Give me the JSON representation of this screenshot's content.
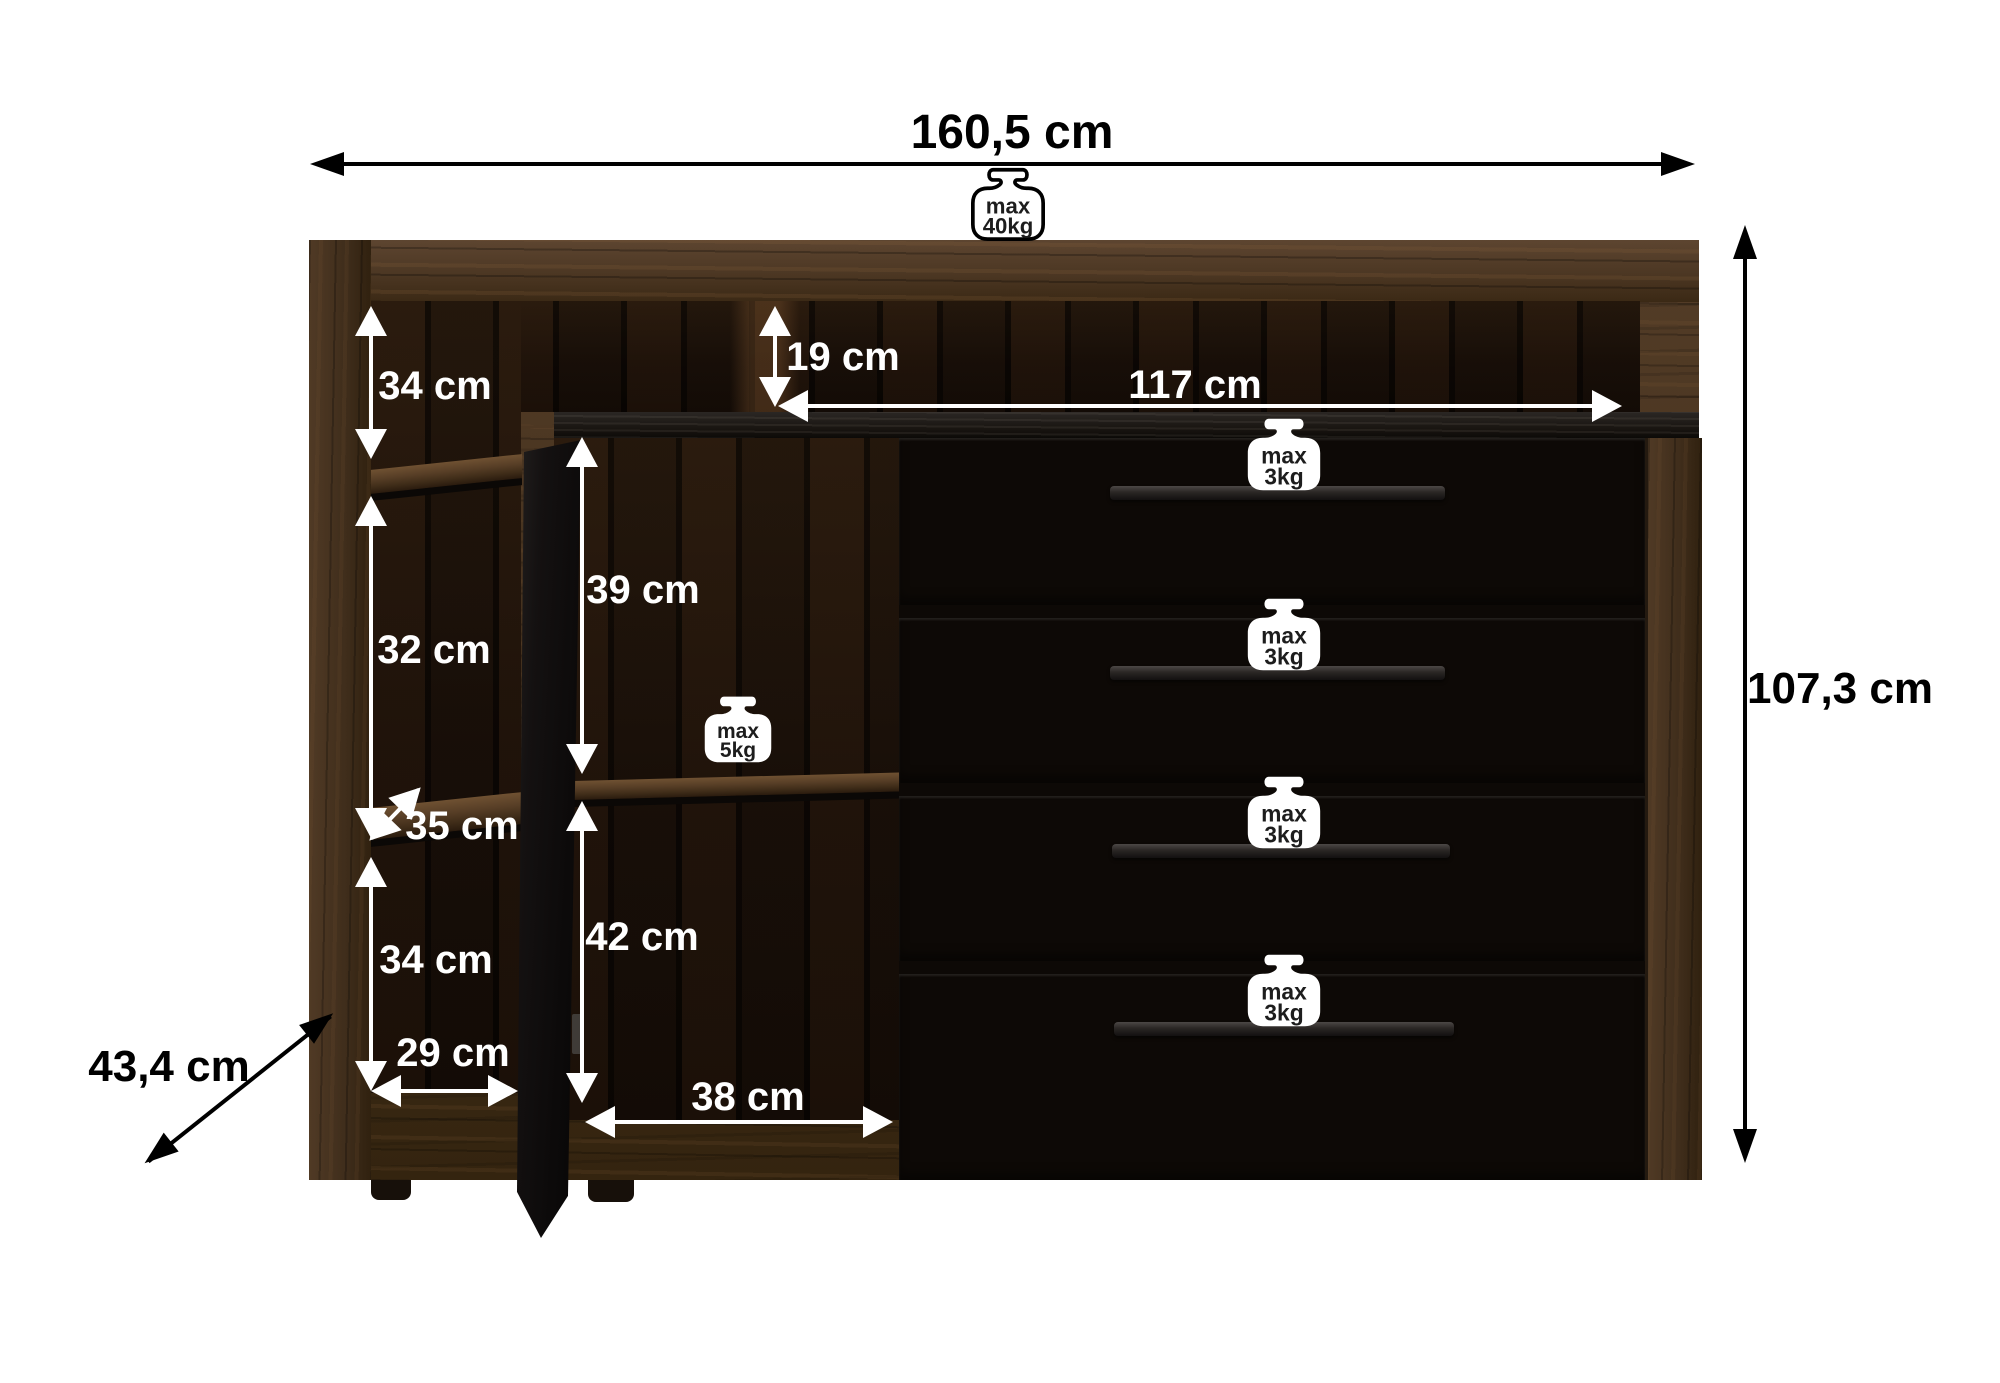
{
  "dimensions": {
    "total_width": "160,5 cm",
    "total_height": "107,3 cm",
    "total_depth": "43,4 cm",
    "top_niche_height": "19 cm",
    "drawer_section_width": "117 cm",
    "left_compartment_top_height": "34 cm",
    "left_compartment_middle_height": "32 cm",
    "left_shelf_depth": "35 cm",
    "left_compartment_bottom_height": "34 cm",
    "left_compartment_width": "29 cm",
    "door_compartment_top_height": "39 cm",
    "door_compartment_bottom_height": "42 cm",
    "door_compartment_width": "38 cm"
  },
  "weight_limits": {
    "top_surface": {
      "line1": "max",
      "line2": "40kg",
      "icon": "weight-icon"
    },
    "middle_shelf": {
      "line1": "max",
      "line2": "5kg",
      "icon": "weight-icon"
    },
    "drawers": [
      {
        "line1": "max",
        "line2": "3kg",
        "icon": "weight-icon"
      },
      {
        "line1": "max",
        "line2": "3kg",
        "icon": "weight-icon"
      },
      {
        "line1": "max",
        "line2": "3kg",
        "icon": "weight-icon"
      },
      {
        "line1": "max",
        "line2": "3kg",
        "icon": "weight-icon"
      }
    ]
  },
  "colors": {
    "background": "#ffffff",
    "wood_frame": "#4a3424",
    "wood_drawer": "#4e3828",
    "interior_dark": "#140d07",
    "shelf_wood": "#5a4128",
    "edge_black": "#191514",
    "door_black": "#131010",
    "annotation_white": "#ffffff",
    "annotation_black": "#000000"
  }
}
